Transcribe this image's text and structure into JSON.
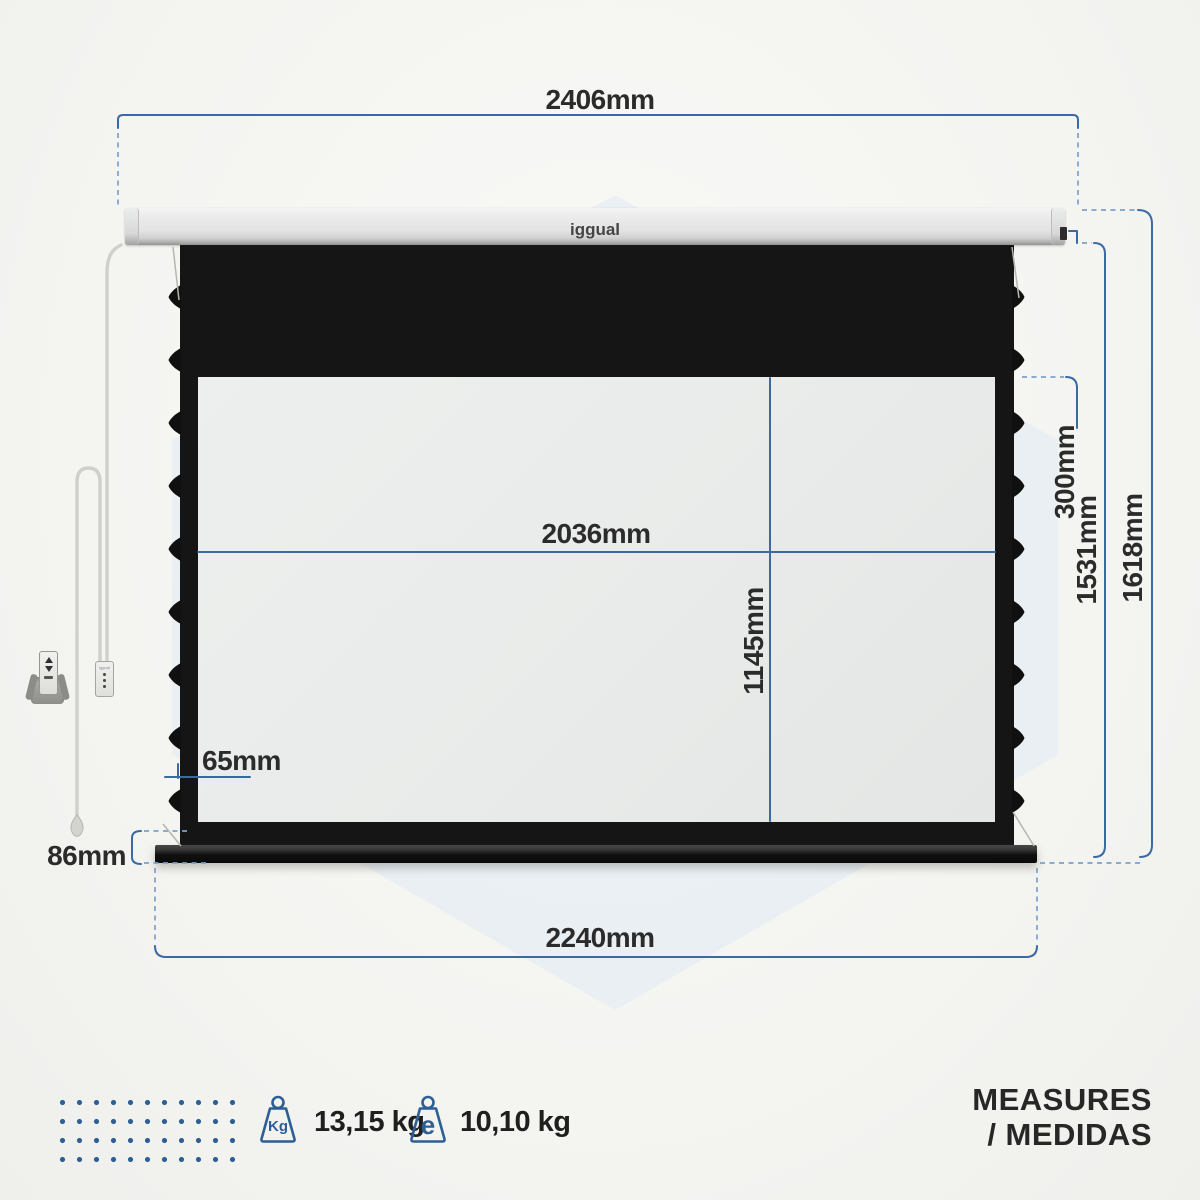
{
  "product": {
    "brand_logo": "iggual",
    "type_note": "projection screen dimension diagram"
  },
  "dimensions": {
    "housing_width": "2406mm",
    "viewing_width": "2036mm",
    "viewing_height": "1145mm",
    "top_black_drop": "300mm",
    "drop_height": "1531mm",
    "total_height": "1618mm",
    "bottom_bar_width": "2240mm",
    "bottom_bar_height": "86mm",
    "side_border_width": "65mm"
  },
  "accessories": {
    "wall_switch_label": "iggual"
  },
  "footer": {
    "weights": [
      {
        "icon_label": "Kg",
        "value": "13,15 kg"
      },
      {
        "icon_label": "e",
        "value": "10,10 kg"
      }
    ],
    "title_line1": "MEASURES",
    "title_line2": "/ MEDIDAS"
  },
  "colors": {
    "dimension_solid": "#3a69a4",
    "dimension_dashed": "#7ba1ca",
    "accent_blue": "#2d5e94",
    "text": "#2b2b2b",
    "hexagon_watermark": "#e2ebf2"
  }
}
